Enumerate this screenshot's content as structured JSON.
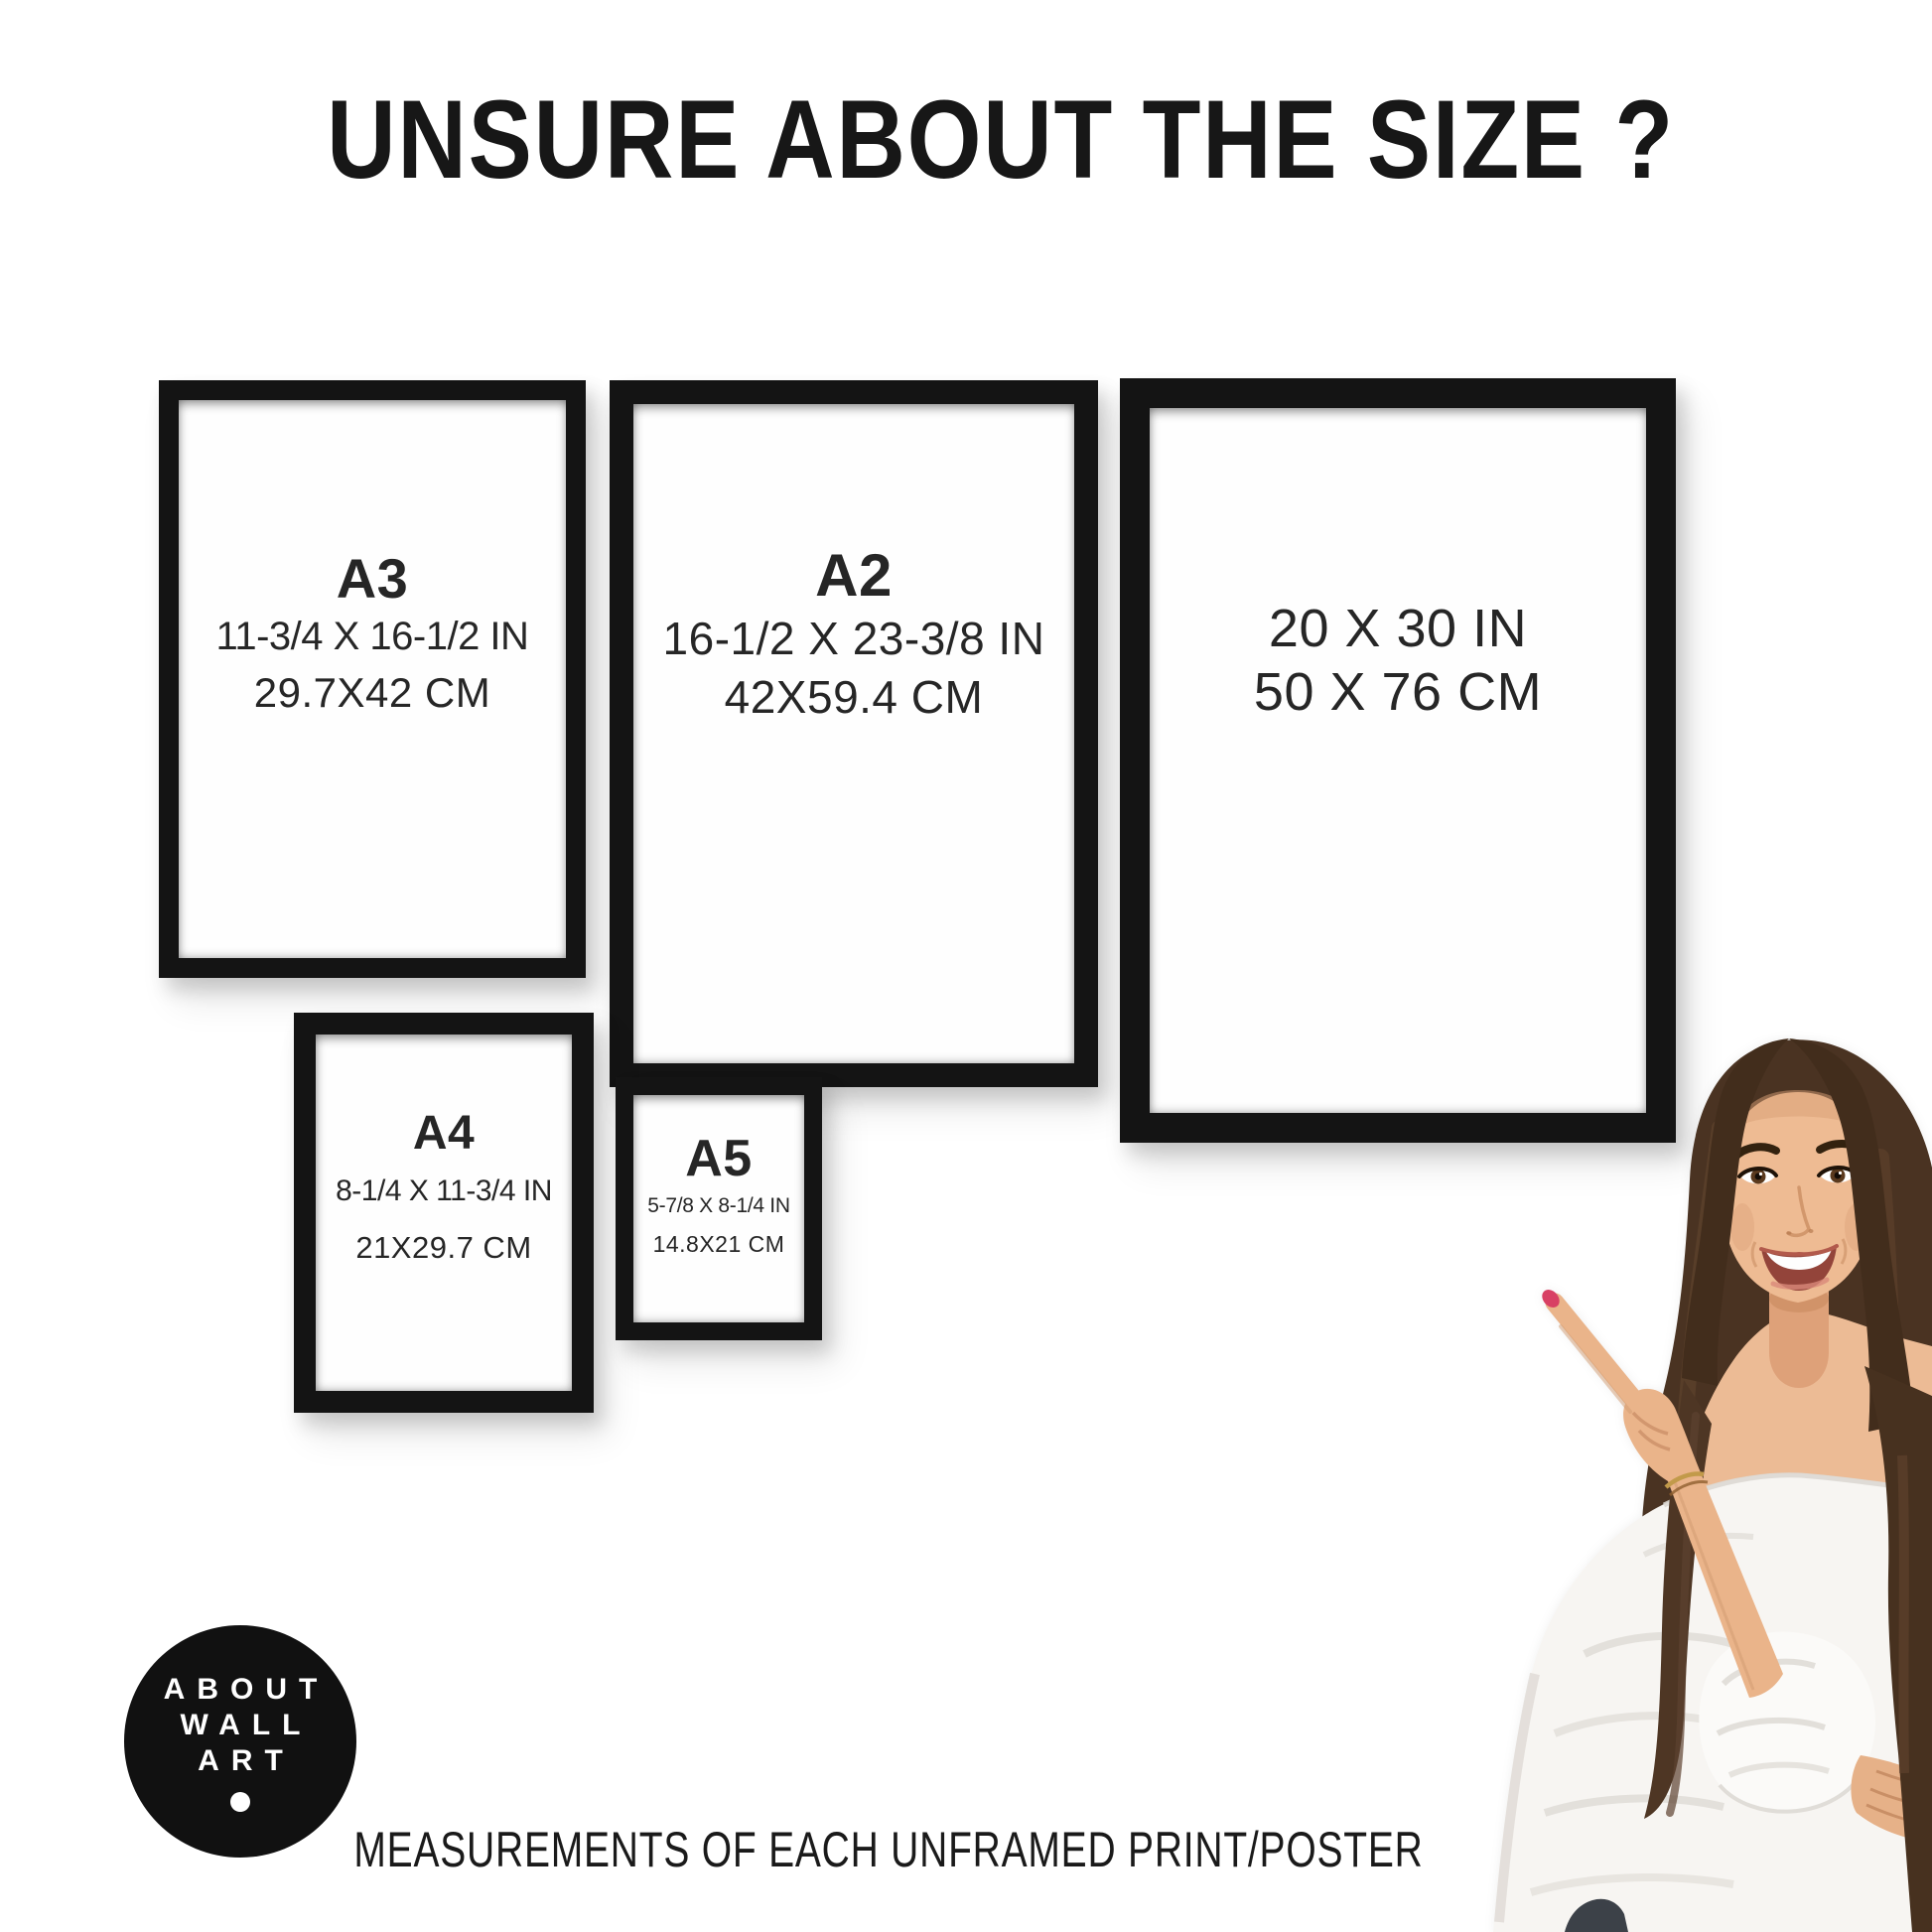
{
  "title": "UNSURE ABOUT THE SIZE ?",
  "frames": [
    {
      "label": "A3",
      "inches": "11-3/4 X 16-1/2 IN",
      "cm": "29.7X42 CM"
    },
    {
      "label": "A2",
      "inches": "16-1/2 X 23-3/8 IN",
      "cm": "42X59.4 CM"
    },
    {
      "label": "",
      "inches": "20 X 30 IN",
      "cm": "50 X 76 CM"
    },
    {
      "label": "A4",
      "inches": "8-1/4 X 11-3/4 IN",
      "cm": "21X29.7 CM"
    },
    {
      "label": "A5",
      "inches": "5-7/8 X 8-1/4 IN",
      "cm": "14.8X21 CM"
    }
  ],
  "logo": {
    "line1": "ABOUT",
    "line2": "WALL",
    "line3": "ART"
  },
  "caption": "MEASUREMENTS OF EACH UNFRAMED PRINT/POSTER",
  "colors": {
    "background": "#ffffff",
    "frame": "#141414",
    "text": "#1e1e1e",
    "logo_bg": "#111111",
    "logo_text": "#ffffff",
    "hair": "#4a3322",
    "skin": "#ecbb95",
    "blouse": "#f7f5f2",
    "nail": "#d84064"
  }
}
